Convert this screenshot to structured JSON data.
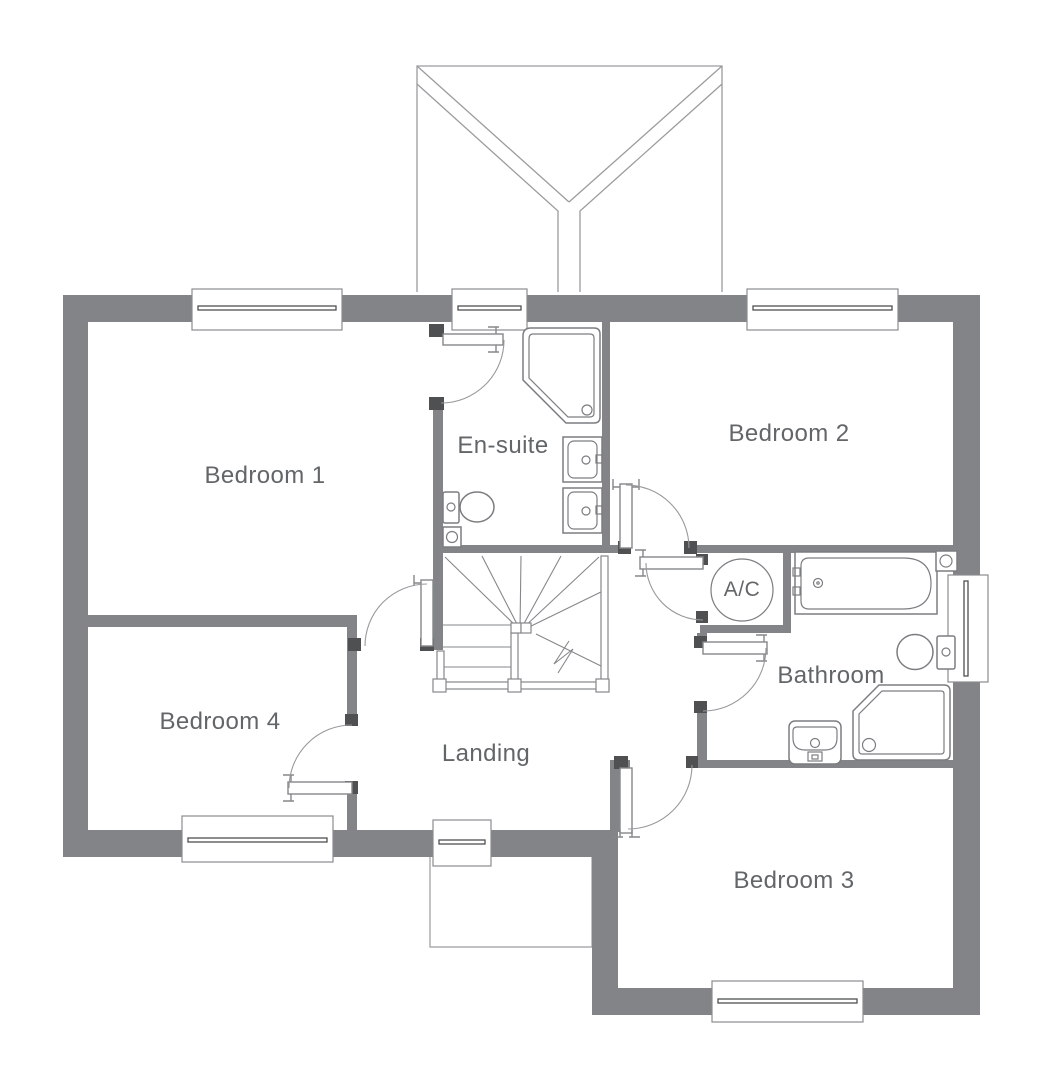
{
  "plan": {
    "labels": {
      "bedroom1": "Bedroom 1",
      "bedroom2": "Bedroom 2",
      "bedroom3": "Bedroom 3",
      "bedroom4": "Bedroom 4",
      "ensuite": "En-suite",
      "bathroom": "Bathroom",
      "landing": "Landing",
      "ac": "A/C"
    },
    "colors": {
      "wall": "#828487",
      "wall_dark": "#4f5052",
      "line": "#7b7d80",
      "line_light": "#9a9c9e",
      "text": "#636669",
      "bg": "#ffffff"
    }
  }
}
